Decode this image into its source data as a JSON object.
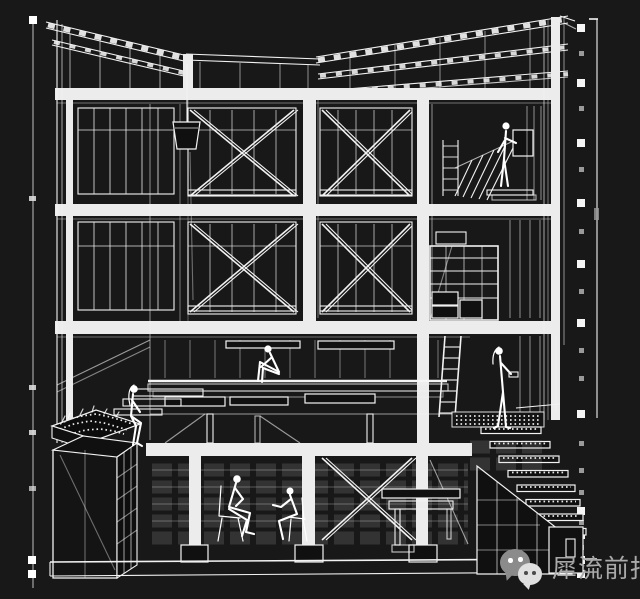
{
  "watermark": {
    "account_name": "犀流前报",
    "icon": "wechat-icon",
    "text_color": "#a9a9a9",
    "bubble_dark": "#8b8b8b",
    "bubble_light": "#e0e0e0"
  },
  "palette": {
    "background": "#181818",
    "line": "#f2f2f2",
    "slab_fill": "#ececec",
    "pane": "#101010"
  },
  "drawing": {
    "kind": "white wireframe axonometric building section on black",
    "storeys_visible": 4,
    "roof": "butterfly / double-shed trussed roof, valley left of centre, rising to the right",
    "bracing": "X cross-braced glazed bays on the two upper storeys and in the basement",
    "left_dimension_ticks": 6,
    "right_dimension_marker_squares": 11,
    "figures": [
      "standing person on upper-right gallery",
      "person seated on planter edge (left)",
      "person seated hugging knees on deck (centre)",
      "standing person at stair landing (right)",
      "two people seated on chairs in basement"
    ],
    "elements": [
      "hanging bucket on rope",
      "ladder",
      "shelving rack",
      "planter with shrubs",
      "storage cabinet",
      "grated stair flight to lower right",
      "basement table"
    ]
  }
}
